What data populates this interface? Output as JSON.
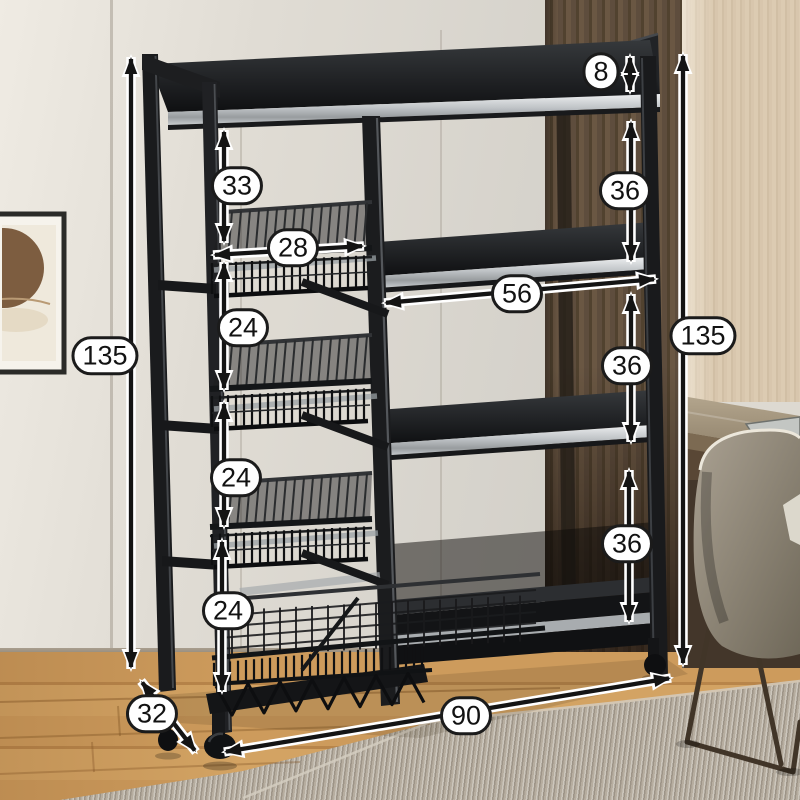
{
  "image_type": "product dimension photo of a black metal kitchen storage rack with wire baskets, shelves and casters",
  "dimensions": {
    "total_height_left": "135",
    "total_height_right": "135",
    "top_gap": "33",
    "basket_width": "28",
    "basket_gaps": [
      "24",
      "24",
      "24"
    ],
    "back_rail_height": "8",
    "shelf_gaps": [
      "36",
      "36",
      "36"
    ],
    "middle_shelf_width": "56",
    "base_width": "90",
    "base_depth": "32"
  },
  "colors": {
    "label_background": "#ffffff",
    "label_border": "#1b1b1b",
    "arrow_ink": "#141414",
    "arrow_halo": "#ffffff",
    "rack_metal": "#1a1b1d",
    "shelf_edge_silver": "#bfc3c6",
    "accent_wall_wood": "#5a4936",
    "side_wall": "#e5e1d9",
    "floor_wood": "#c8964f",
    "rug": "#b6ad9f"
  }
}
